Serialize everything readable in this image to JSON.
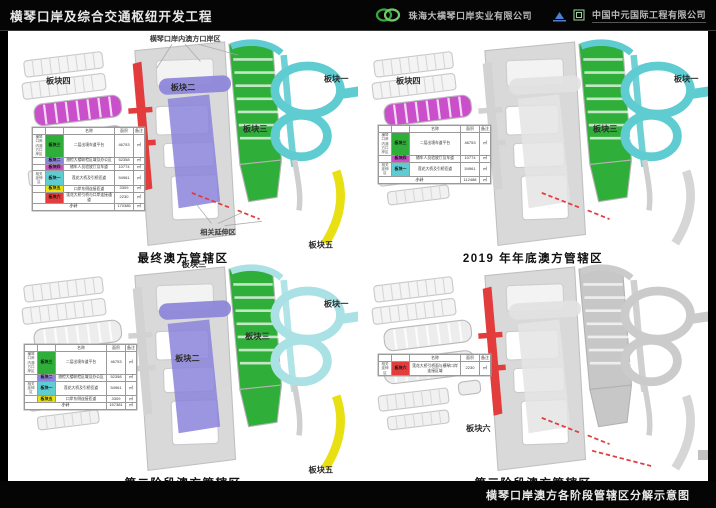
{
  "header": {
    "title": "横琴口岸及综合交通枢纽开发工程",
    "company1": "珠海大横琴口岸实业有限公司",
    "company2": "中国中元国际工程有限公司"
  },
  "footer": {
    "caption": "横琴口岸澳方各阶段管辖区分解示意图"
  },
  "block_colors": {
    "block1": "#5fccd2",
    "block2": "#8b84da",
    "block3": "#2fae3a",
    "block4": "#c94fcb",
    "block5": "#e8e013",
    "block6": "#e23c3c"
  },
  "legend_header": {
    "name": "名称",
    "area": "面积",
    "note": "备注"
  },
  "unit": "㎡",
  "quadrants": [
    {
      "caption": "最终澳方管辖区",
      "annotation_top": "横琴口岸内澳方口岸区",
      "annotation_ext": "相关延伸区",
      "labels": {
        "block1": "板块一",
        "block2": "板块二",
        "block3": "板块三",
        "block4": "板块四",
        "block5": "板块五",
        "block6": "板块六"
      },
      "legend": {
        "rows": [
          {
            "group": "横琴口岸内澳方口岸区",
            "block": "block3",
            "name": "板块三",
            "desc": "二层出境车道平台",
            "area": "46753"
          },
          {
            "group": "",
            "block": "block2",
            "name": "板块二",
            "desc": "旅检大楼联检区域及办公区",
            "area": "52358"
          },
          {
            "group": "",
            "block": "block4",
            "name": "板块四",
            "desc": "随车人员验放厅及车道",
            "area": "10774"
          },
          {
            "group": "相关延伸区",
            "block": "block1",
            "name": "板块一",
            "desc": "莲花大桥及引桥匝道",
            "area": "54961"
          },
          {
            "group": "",
            "block": "block5",
            "name": "板块五",
            "desc": "口岸东侧连接匝道",
            "area": "3309"
          },
          {
            "group": "",
            "block": "block6",
            "name": "板块六",
            "desc": "莲花大桥引桥与口岸连接通道",
            "area": "2230"
          }
        ],
        "subtotal": {
          "label": "小计",
          "area": "170385"
        }
      }
    },
    {
      "caption": "2019 年年底澳方管辖区",
      "labels": {
        "block1": "板块一",
        "block3": "板块三",
        "block4": "板块四"
      },
      "legend": {
        "rows": [
          {
            "group": "横琴口岸内澳方口岸区",
            "block": "block3",
            "name": "板块三",
            "desc": "二层出境车道平台",
            "area": "46753"
          },
          {
            "group": "",
            "block": "block4",
            "name": "板块四",
            "desc": "随车人员验放厅及车道",
            "area": "10774"
          },
          {
            "group": "相关延伸区",
            "block": "block1",
            "name": "板块一",
            "desc": "莲花大桥及引桥匝道",
            "area": "54961"
          }
        ],
        "subtotal": {
          "label": "小计",
          "area": "112488"
        }
      }
    },
    {
      "caption": "第二阶段澳方管辖区",
      "labels": {
        "block1": "板块一",
        "block2": "板块二",
        "block3": "板块三",
        "block5": "板块五"
      },
      "legend": {
        "rows": [
          {
            "group": "横琴口岸内澳方口岸区",
            "block": "block3",
            "name": "板块三",
            "desc": "二层出境车道平台",
            "area": "46753"
          },
          {
            "group": "",
            "block": "block2",
            "name": "板块二",
            "desc": "旅检大楼联检区域及办公区",
            "area": "52358"
          },
          {
            "group": "相关延伸区",
            "block": "block1",
            "name": "板块一",
            "desc": "莲花大桥及引桥匝道",
            "area": "54961"
          },
          {
            "group": "",
            "block": "block5",
            "name": "板块五",
            "desc": "口岸东侧连接匝道",
            "area": "3309"
          }
        ],
        "subtotal": {
          "label": "小计",
          "area": "157381"
        }
      }
    },
    {
      "caption": "第三阶段澳方管辖区",
      "labels": {
        "block6": "板块六"
      },
      "legend": {
        "rows": [
          {
            "group": "相关延伸区",
            "block": "block6",
            "name": "板块六",
            "desc": "莲花大桥引桥面与横琴口岸连接区域",
            "area": "2230"
          }
        ]
      }
    }
  ]
}
